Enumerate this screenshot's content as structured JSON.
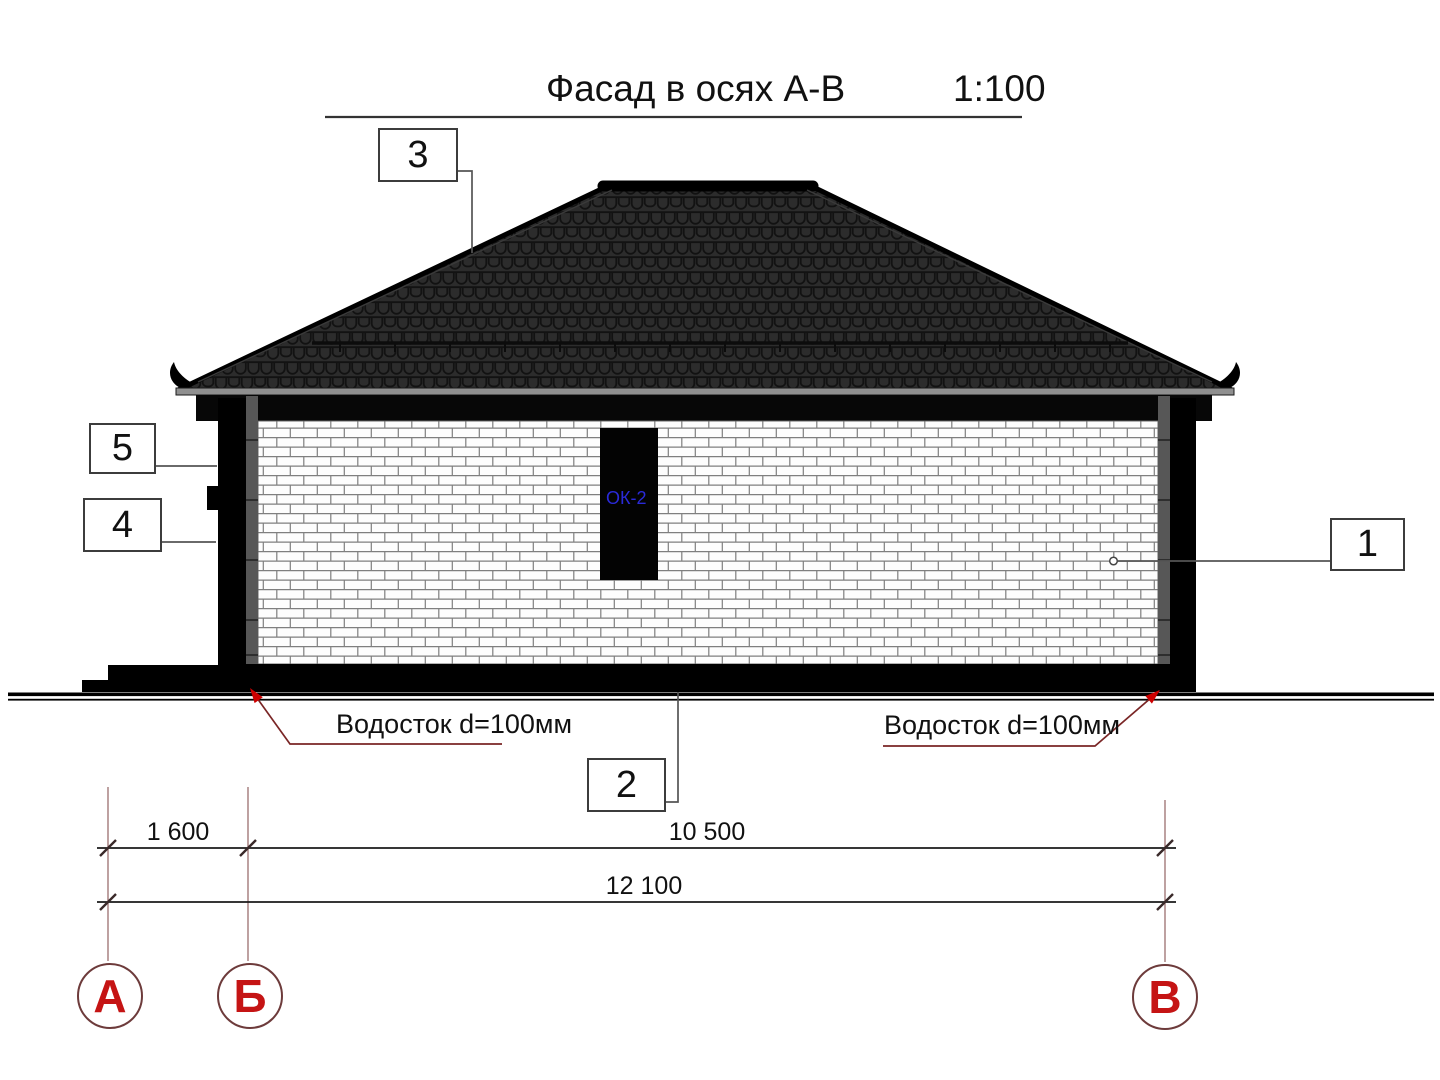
{
  "title": {
    "text": "Фасад в осях А-В",
    "scale": "1:100"
  },
  "callouts": {
    "c1": "1",
    "c2": "2",
    "c3": "3",
    "c4": "4",
    "c5": "5"
  },
  "window_tag": {
    "label": "ОК-2",
    "color": "#2a2ad8"
  },
  "downspouts": {
    "left": "Водосток d=100мм",
    "right": "Водосток d=100мм"
  },
  "dimensions": {
    "a_b": "1 600",
    "b_v": "10 500",
    "a_v": "12 100"
  },
  "axes": {
    "a": "А",
    "b": "Б",
    "v": "В"
  },
  "colors": {
    "axis_letter_red": "#c51414",
    "leader_dark_red": "#7a2626",
    "arrow_red": "#cc0000",
    "window_label_blue": "#2a2ad8",
    "roof_dark": "#2c2c2c",
    "gutter_gray": "#8f8f8f"
  }
}
